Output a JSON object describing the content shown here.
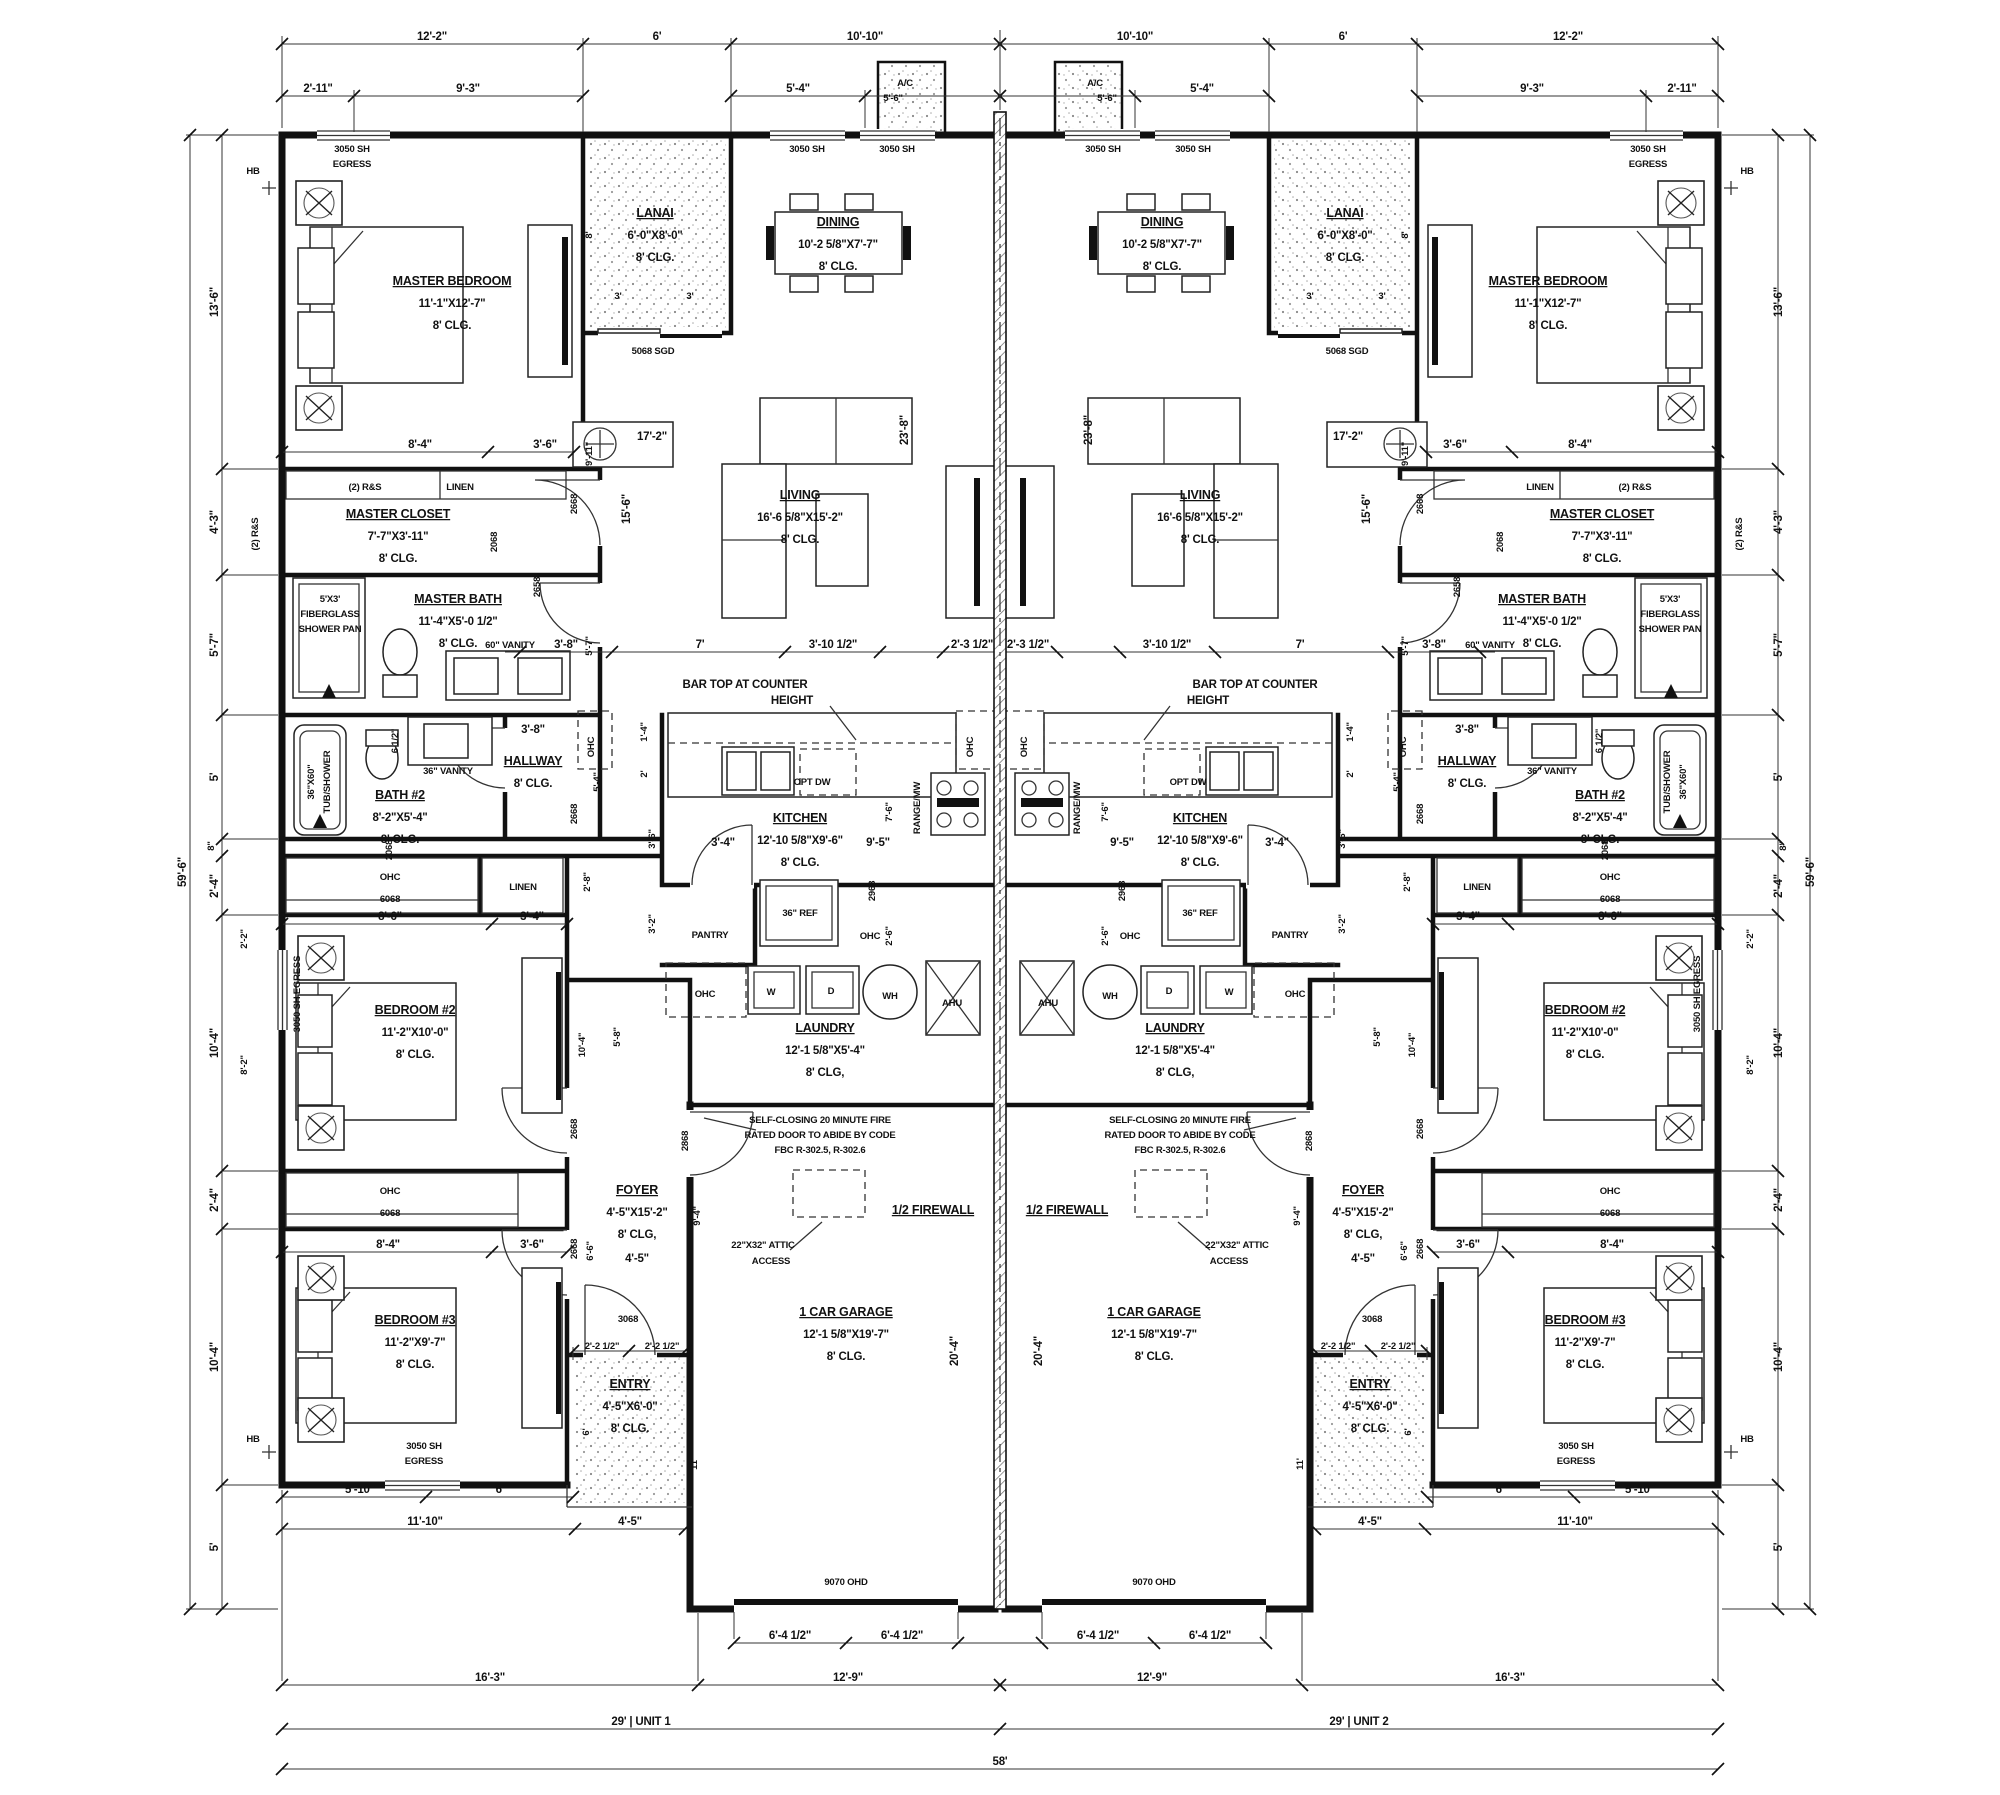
{
  "title": "Duplex Floor Plan - Unit 1 & Unit 2",
  "rooms": {
    "mb": {
      "n": "MASTER BEDROOM",
      "s": "11'-1\"X12'-7\"",
      "c": "8' CLG."
    },
    "lanai": {
      "n": "LANAI",
      "s": "6'-0\"X8'-0\"",
      "c": "8' CLG."
    },
    "dining": {
      "n": "DINING",
      "s": "10'-2 5/8\"X7'-7\"",
      "c": "8' CLG."
    },
    "living": {
      "n": "LIVING",
      "s": "16'-6 5/8\"X15'-2\"",
      "c": "8' CLG."
    },
    "mcl": {
      "n": "MASTER CLOSET",
      "s": "7'-7\"X3'-11\"",
      "c": "8' CLG."
    },
    "mba": {
      "n": "MASTER BATH",
      "s": "11'-4\"X5'-0 1/2\"",
      "c": "8' CLG."
    },
    "b2": {
      "n": "BATH #2",
      "s": "8'-2\"X5'-4\"",
      "c": "8' CLG."
    },
    "hall": {
      "n": "HALLWAY",
      "c": "8' CLG."
    },
    "kit": {
      "n": "KITCHEN",
      "s": "12'-10 5/8\"X9'-6\"",
      "c": "8' CLG."
    },
    "lau": {
      "n": "LAUNDRY",
      "s": "12'-1 5/8\"X5'-4\"",
      "c": "8' CLG,"
    },
    "br2": {
      "n": "BEDROOM #2",
      "s": "11'-2\"X10'-0\"",
      "c": "8' CLG."
    },
    "br3": {
      "n": "BEDROOM #3",
      "s": "11'-2\"X9'-7\"",
      "c": "8' CLG."
    },
    "foy": {
      "n": "FOYER",
      "s": "4'-5\"X15'-2\"",
      "c": "8' CLG,",
      "e": "4'-5\""
    },
    "ent": {
      "n": "ENTRY",
      "s": "4'-5\"X6'-0\"",
      "c": "8' CLG."
    },
    "gar": {
      "n": "1 CAR GARAGE",
      "s": "12'-1 5/8\"X19'-7\"",
      "c": "8' CLG."
    }
  },
  "ann": {
    "sh": "3050 SH",
    "eg": "EGRESS",
    "sheg": "3050 SH EGRESS",
    "sgd": "5068 SGD",
    "rs": "(2) R&S",
    "linen": "LINEN",
    "pan1": "5'X3'",
    "pan2": "FIBERGLASS",
    "pan3": "SHOWER PAN",
    "v60": "60\" VANITY",
    "v36": "36\" VANITY",
    "tub1": "36\"X60\"",
    "tub2": "TUB/SHOWER",
    "bar1": "BAR TOP AT COUNTER",
    "bar2": "HEIGHT",
    "dw": "OPT DW",
    "rng": "RANGE/MW",
    "ref": "36\" REF",
    "pantry": "PANTRY",
    "ohc": "OHC",
    "c6068": "6068",
    "w": "W",
    "d": "D",
    "wh": "WH",
    "ahu": "AHU",
    "f1": "SELF-CLOSING 20 MINUTE FIRE",
    "f2": "RATED DOOR TO ABIDE BY CODE",
    "f3": "FBC R-302.5, R-302.6",
    "at1": "22\"X32\" ATTIC",
    "at2": "ACCESS",
    "fw": "1/2 FIREWALL",
    "ohd": "9070 OHD",
    "hb": "HB",
    "ac": "A/C",
    "d2068": "2068",
    "d2658": "2658",
    "d2668": "2668",
    "d2868": "2868",
    "d2968": "2968",
    "d3068": "3068"
  },
  "dims": {
    "top1": [
      "12'-2\"",
      "6'",
      "10'-10\"",
      "10'-10\"",
      "6'",
      "12'-2\""
    ],
    "top2": [
      "2'-11\"",
      "9'-3\"",
      "5'-4\"",
      "5'-6\"",
      "5'-6\"",
      "5'-4\"",
      "9'-3\"",
      "2'-11\""
    ],
    "side": [
      "13'-6\"",
      "4'-3\"",
      "5'-7\"",
      "5'",
      "8\"",
      "2'-4\"",
      "10'-4\"",
      "2'-4\"",
      "10'-4\"",
      "5'"
    ],
    "sideT": "59'-6\"",
    "bot1": "6'-4 1/2\"",
    "bot2": [
      "16'-3\"",
      "12'-9\""
    ],
    "u1": "29' | UNIT 1",
    "u2": "29' | UNIT 2",
    "total": "58'",
    "int": {
      "d84": "8'-4\"",
      "d36": "3'-6\"",
      "d86": "8'-6\"",
      "d34": "3'-4\"",
      "d911": "9'-11\"",
      "d156": "15'-6\"",
      "d57": "5'-7\"",
      "d54": "5'-4\"",
      "d172": "17'-2\"",
      "d238": "23'-8\"",
      "d38": "3'-8\"",
      "d7": "7'",
      "d310": "3'-10 1/2\"",
      "d23": "2'-3 1/2\"",
      "d14": "1'-4\"",
      "d2": "2'",
      "d28": "2'-8\"",
      "d32": "3'-2\"",
      "d95": "9'-5\"",
      "d76": "7'-6\"",
      "d26": "2'-6\"",
      "d22": "2'-2\"",
      "d82": "8'-2\"",
      "d104": "10'-4\"",
      "d58": "5'-8\"",
      "h612": "6 1/2\"",
      "d94": "9'-4\"",
      "d66": "6'-6\"",
      "d6": "6'",
      "d11": "11'",
      "d204": "20'-4\"",
      "e22": "2'-2 1/2\"",
      "s510": "5'-10\"",
      "s1110": "11'-10\"",
      "s45": "4'-5\"",
      "lan8": "8'",
      "lan3": "3'"
    }
  }
}
